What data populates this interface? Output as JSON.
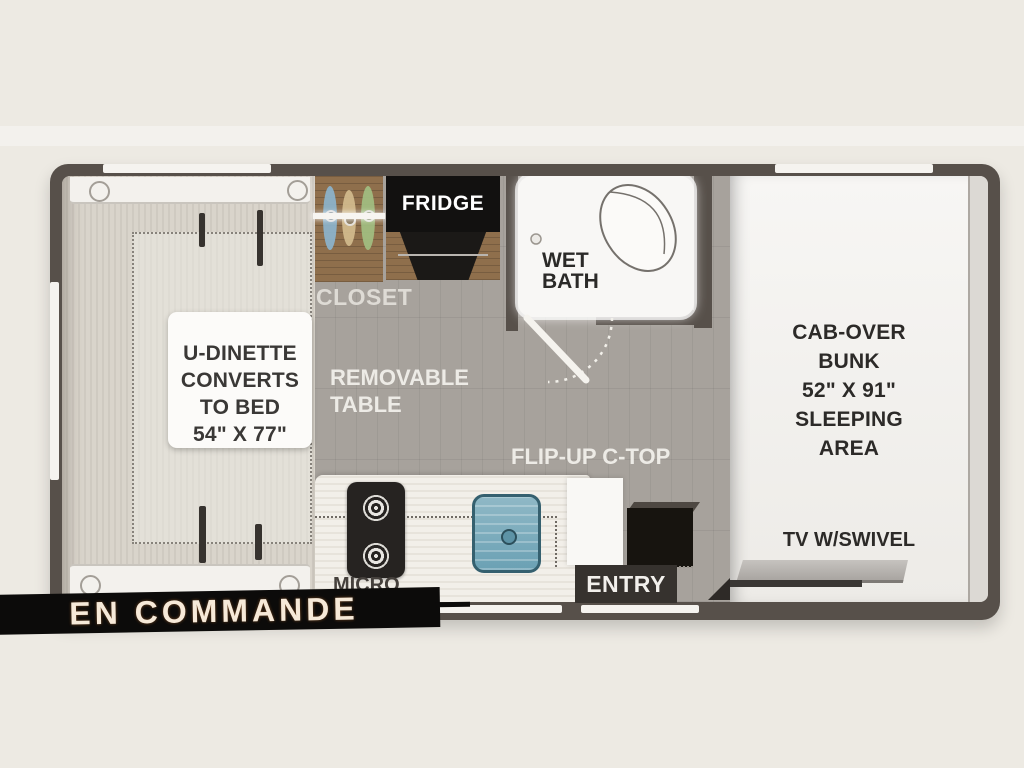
{
  "status_banner": {
    "label": "EN COMMANDE"
  },
  "floorplan": {
    "dinette": {
      "line1": "U-DINETTE",
      "line2": "CONVERTS",
      "line3": "TO BED",
      "line4": "54\" X 77\""
    },
    "closet": {
      "label": "CLOSET"
    },
    "fridge": {
      "label": "FRIDGE"
    },
    "wet_bath": {
      "line1": "WET",
      "line2": "BATH"
    },
    "removable_table": {
      "line1": "REMOVABLE",
      "line2": "TABLE"
    },
    "flip_up_ctop": {
      "label": "FLIP-UP C-TOP"
    },
    "cab_over": {
      "line1": "CAB-OVER",
      "line2": "BUNK",
      "line3": "52\" X 91\"",
      "line4": "SLEEPING",
      "line5": "AREA"
    },
    "tv": {
      "label": "TV W/SWIVEL"
    },
    "micro": {
      "label": "MICRO"
    },
    "entry": {
      "label": "ENTRY"
    }
  },
  "colors": {
    "wall": "#57504a",
    "banner_bg": "#0c0b0a",
    "banner_text": "#f6e9d8",
    "floor_gray": "#a7a29c",
    "floor_wood_light": "#d9d4cb",
    "bath_white": "#f8f7f5",
    "sink_blue": "#6ba1b4",
    "hanger_blue": "#8cb4cd",
    "hanger_tan": "#d3bb8e",
    "hanger_green": "#a2bf82"
  }
}
